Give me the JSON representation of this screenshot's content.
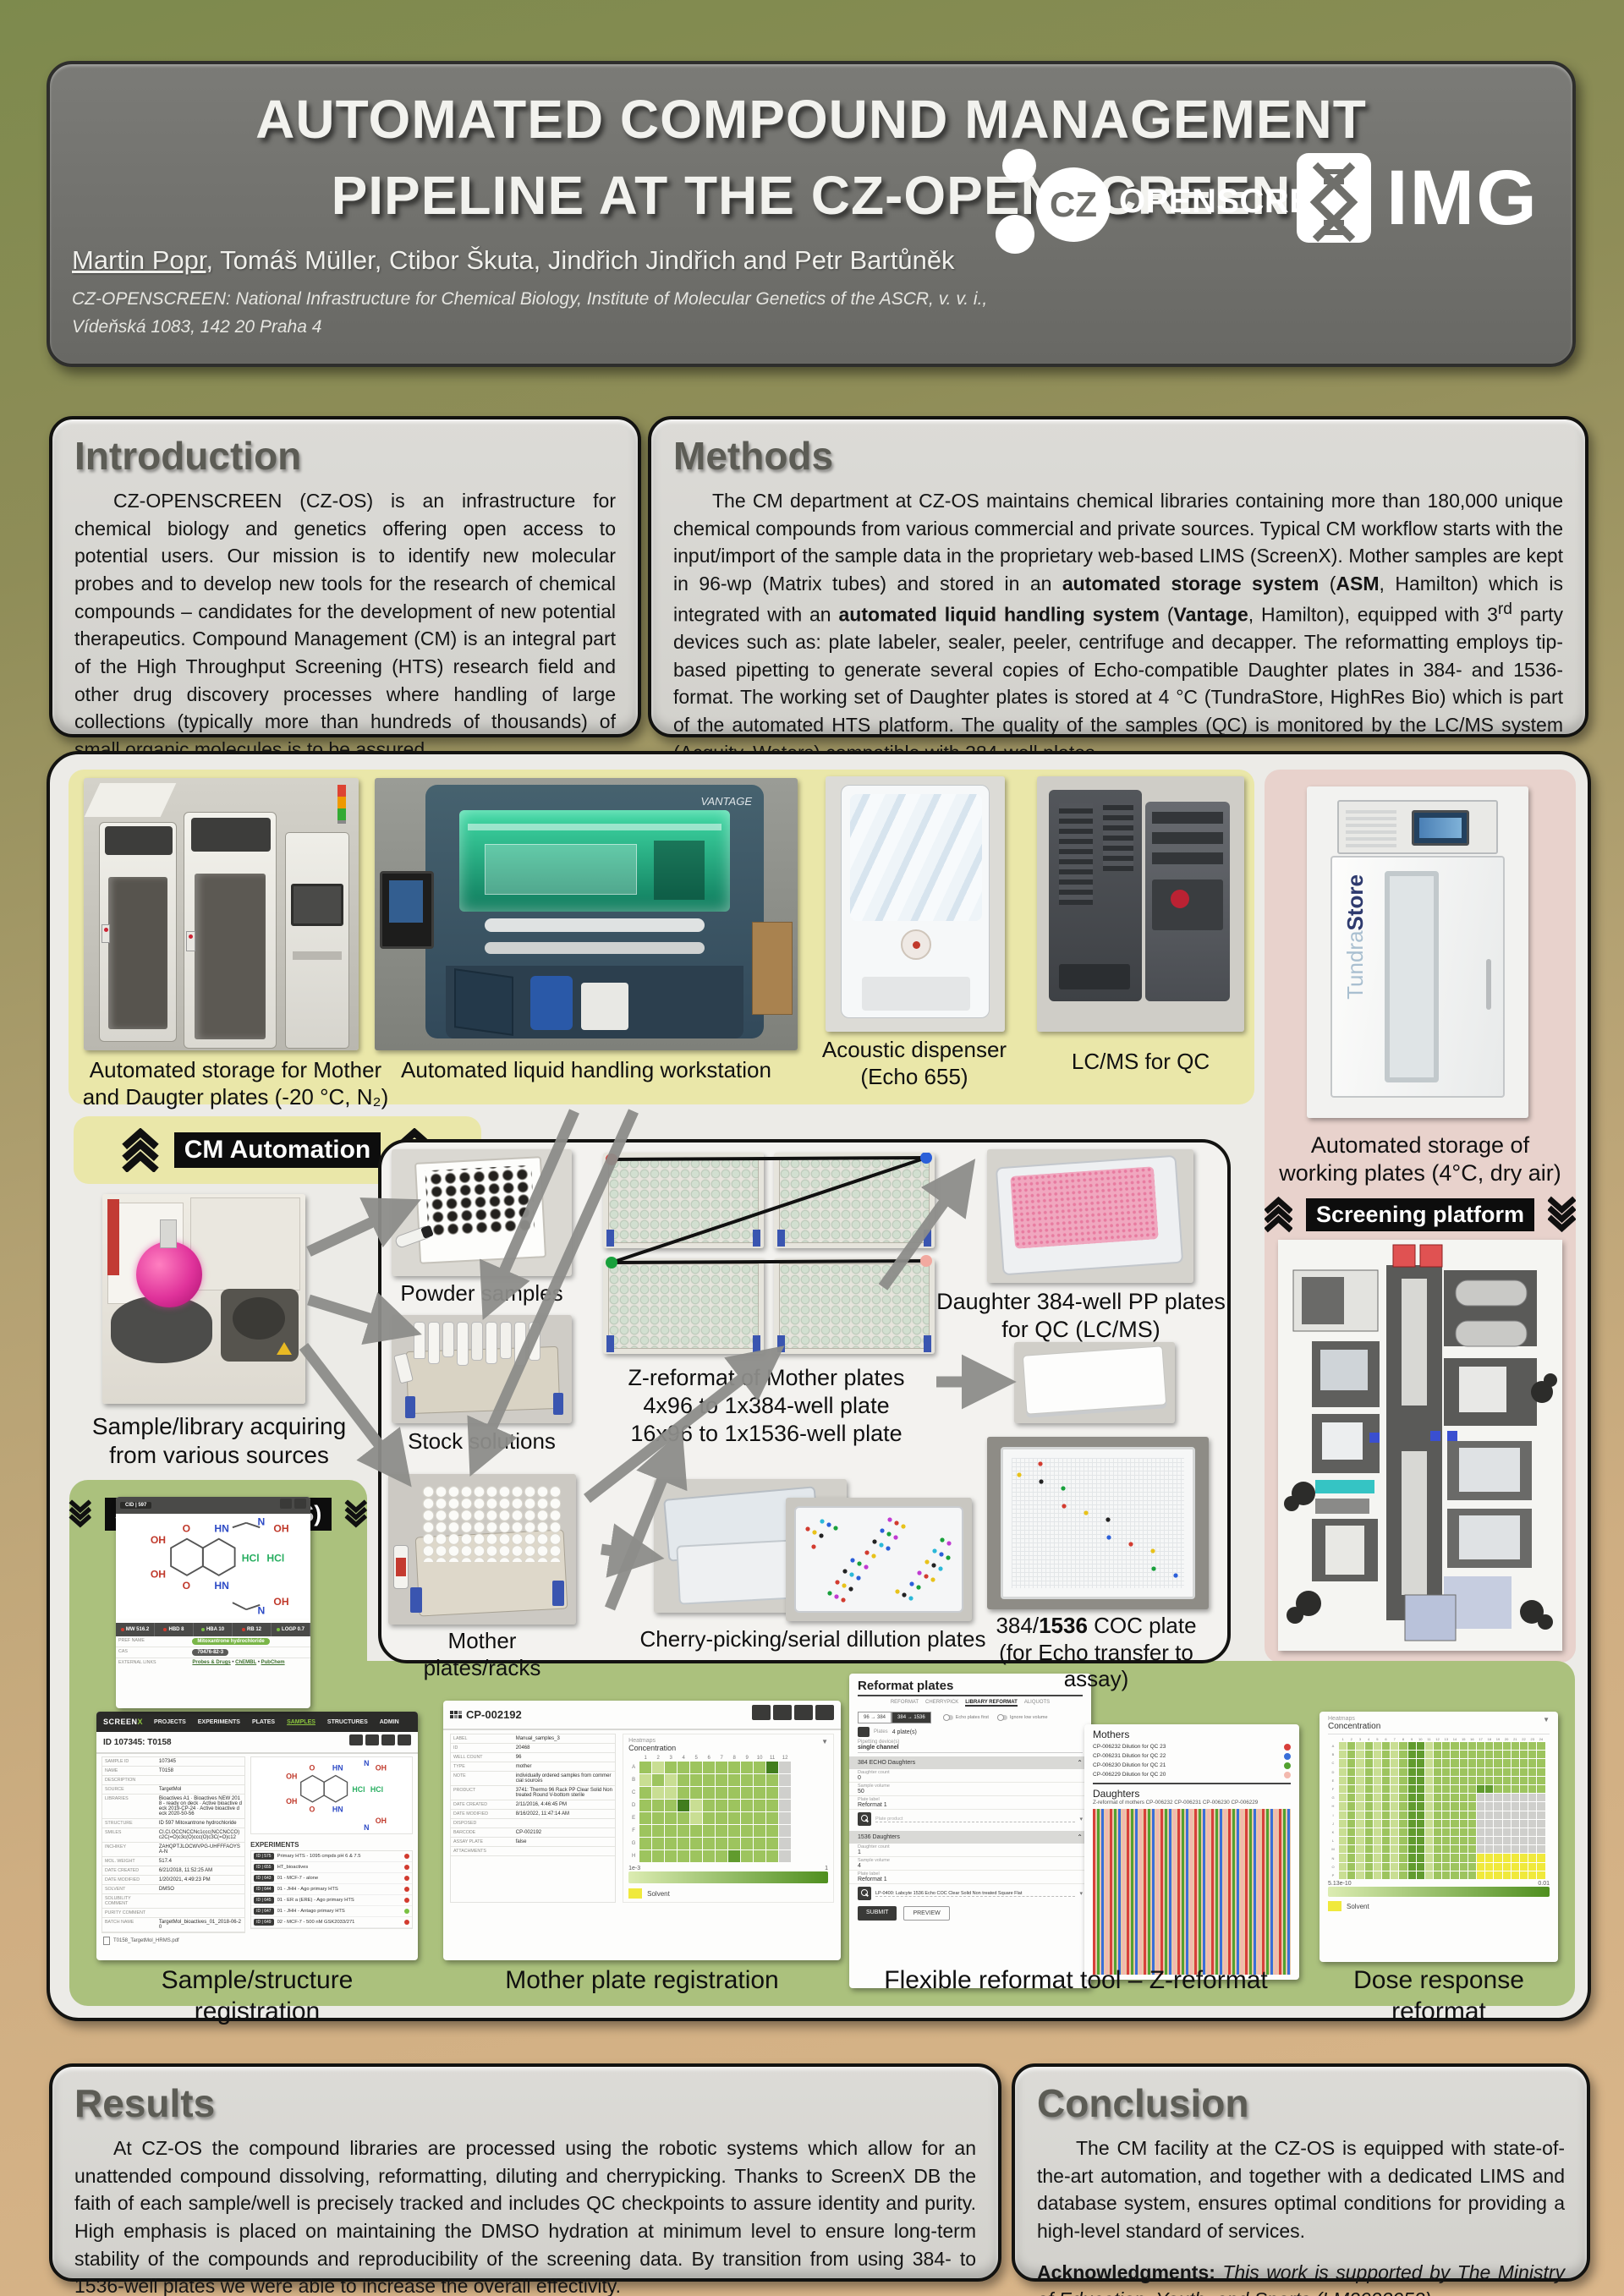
{
  "header": {
    "title_line1": "AUTOMATED COMPOUND MANAGEMENT",
    "title_line2": "PIPELINE AT THE CZ-OPENSCREEN",
    "authors_lead": "Martin Popr",
    "authors_rest": ", Tomáš Müller, Ctibor Škuta, Jindřich Jindřich and Petr Bartůněk",
    "affiliation_line1": "CZ-OPENSCREEN: National Infrastructure for Chemical Biology, Institute of Molecular Genetics of the ASCR, v. v. i.,",
    "affiliation_line2": "Vídeňská 1083, 142 20 Praha 4",
    "cz_logo_cz": "CZ",
    "cz_logo_text": "OPENSCREEN",
    "img_logo_text": "IMG"
  },
  "intro": {
    "heading": "Introduction",
    "body": "CZ-OPENSCREEN (CZ-OS) is an infrastructure for chemical biology and genetics offering open access to potential users. Our mission is to identify new molecular probes and to develop new tools for the research of chemical compounds – candidates for the development of new potential therapeutics. Compound Management (CM) is an integral part of the High Throughput Screening (HTS) research field and other drug discovery processes where handling of large collections (typically more than hundreds of thousands) of small organic molecules is to be assured."
  },
  "methods": {
    "heading": "Methods",
    "segments": [
      {
        "t": "The CM department at CZ-OS maintains chemical libraries containing more than 180,000 unique chemical compounds from various commercial and private sources. Typical CM workflow starts with the input/import of the sample data in the proprietary web-based LIMS (ScreenX). Mother samples are kept in 96-wp (Matrix tubes) and stored in an "
      },
      {
        "t": "automated storage system",
        "b": 1
      },
      {
        "t": " ("
      },
      {
        "t": "ASM",
        "b": 1
      },
      {
        "t": ", Hamilton) which is integrated with an "
      },
      {
        "t": "automated liquid handling system",
        "b": 1
      },
      {
        "t": " ("
      },
      {
        "t": "Vantage",
        "b": 1
      },
      {
        "t": ", Hamilton), equipped with 3"
      },
      {
        "t": "rd",
        "sup": 1
      },
      {
        "t": " party devices such as: plate labeler, sealer, peeler, centrifuge and decapper. The reformatting employs tip-based pipetting to generate several copies of Echo-compatible Daughter plates in 384- and 1536-format. The working set of Daughter plates is stored at 4 °C (TundraStore, HighRes Bio) which is part of the automated HTS platform. The quality of the samples (QC) is monitored by the LC/MS system (Acquity, Waters) compatible with 384-well plates."
      }
    ]
  },
  "results": {
    "heading": "Results",
    "body": "At CZ-OS the compound libraries are processed using the robotic systems which allow for an unattended compound dissolving, reformatting, diluting and cherrypicking. Thanks to ScreenX DB the faith of each sample/well is precisely tracked and includes QC checkpoints to assure identity and purity. High emphasis is placed on maintaining the DMSO hydration at minimum level to ensure long-term stability of the compounds and reproducibility of the screening data. By transition from using 384- to 1536-well plates we were able to increase the overall effectivity."
  },
  "conclusion": {
    "heading": "Conclusion",
    "body": "The CM facility at the CZ-OS is equipped with state-of-the-art automation, and together with a dedicated LIMS and database system, ensures optimal conditions for providing a high-level standard of services.",
    "ack_label": "Acknowledgments:",
    "ack_text": " This work is supported by The Ministry of Education, Youth, and Sports (LM2023052)."
  },
  "badges": {
    "cm": "CM Automation",
    "screenx": "ScreenX DB (LIMS)",
    "platform": "Screening platform"
  },
  "pipeline": {
    "cap_storage": [
      "Automated storage for Mother",
      "and Daugter plates (-20 °C, N₂)"
    ],
    "cap_liquid": "Automated liquid handling workstation",
    "cap_acoustic": [
      "Acoustic dispenser",
      "(Echo 655)"
    ],
    "cap_lcms": "LC/MS for QC",
    "cap_tundra": [
      "Automated storage of",
      "working plates (4°C, dry air)"
    ],
    "cap_sample": [
      "Sample/library acquiring",
      "from various sources"
    ],
    "cap_powder": "Powder samples",
    "cap_stock": "Stock solutions",
    "cap_mother": "Mother plates/racks",
    "zreformat": [
      "Z-reformat of Mother plates",
      "4x96 to 1x384-well plate",
      "16x96 to 1x1536-well plate"
    ],
    "cap_daughter": [
      "Daughter 384-well PP plates",
      "for QC (LC/MS)"
    ],
    "cap_cherry": "Cherry-picking/serial dillution plates",
    "cap_coc_line1": [
      {
        "t": "384/"
      },
      {
        "t": "1536",
        "b": 1
      },
      {
        "t": " COC plate"
      }
    ],
    "cap_coc_line2": "(for Echo transfer to assay)",
    "tundra_label_light": "Tundra",
    "tundra_label_bold": "Store",
    "vantage_label": "VANTAGE"
  },
  "cid_card": {
    "header": "CID | 597",
    "metrics": [
      [
        "MW",
        "516.2",
        "r"
      ],
      [
        "HBD",
        "8",
        "r"
      ],
      [
        "HBA",
        "10",
        "g"
      ],
      [
        "RB",
        "12",
        "r"
      ],
      [
        "LOGP",
        "0.7",
        "g"
      ]
    ],
    "pref_label": "PREF NAME",
    "pref_value": "Mitoxantrone hydrochloride",
    "cas_label": "CAS",
    "cas_value": "70476-82-3",
    "links_label": "EXTERNAL LINKS",
    "links": [
      "Probes & Drugs",
      "ChEMBL",
      "PubChem"
    ]
  },
  "shots": {
    "screenx": {
      "brand": "SCREENX",
      "nav": [
        "PROJECTS",
        "EXPERIMENTS",
        "PLATES",
        "SAMPLES",
        "STRUCTURES",
        "ADMIN"
      ],
      "record": "ID 107345: T0158",
      "fields": [
        [
          "SAMPLE ID",
          "107345"
        ],
        [
          "NAME",
          "T0158"
        ],
        [
          "DESCRIPTION",
          ""
        ],
        [
          "SOURCE",
          "TargetMol"
        ],
        [
          "LIBRARIES",
          "Bioactives A1 · Bioactives NEW 2018 - ready on deck · Active bioactive deck 2019-CP-24 · Active bioactive deck 2020-50-56"
        ],
        [
          "STRUCTURE",
          "ID 597 Mitoxantrone hydrochloride"
        ],
        [
          "SMILES",
          "Cl.Cl.OCCNCCNc1ccc(NCCNCCO)c2C(=O)c3c(O)ccc(O)c3C(=O)c12"
        ],
        [
          "INCHIKEY",
          "ZAHQPTJLOCWVPG-UHFFFAOYSA-N"
        ],
        [
          "MOL. WEIGHT",
          "517.4"
        ],
        [
          "DATE CREATED",
          "6/21/2018, 11:52:25 AM"
        ],
        [
          "DATE MODIFIED",
          "1/20/2021, 4:49:23 PM"
        ],
        [
          "SOLVENT",
          "DMSO"
        ],
        [
          "SOLUBILITY COMMENT",
          ""
        ],
        [
          "PURITY COMMENT",
          ""
        ],
        [
          "BATCH NAME",
          "TargetMol_bioactives_01_2018-06-20"
        ]
      ],
      "attachment": "T0158_TargetMol_HRMS.pdf",
      "exp_title": "EXPERIMENTS",
      "experiments": [
        [
          "ID | 575",
          "Primary HTS - 1095 cmpds pH 6 & 7.5",
          "r"
        ],
        [
          "ID | 655",
          "HT_bioactives",
          "r"
        ],
        [
          "ID | 643",
          "01 - MCF-7 - alone",
          "r"
        ],
        [
          "ID | 644",
          "01 - JHH - Ago primary HTS",
          "r"
        ],
        [
          "ID | 645",
          "01 - ER a (ERE) - Ago primary HTS",
          "r"
        ],
        [
          "ID | 647",
          "01 - JHH - Antago primary HTS",
          "g"
        ],
        [
          "ID | 649",
          "02 - MCF-7 - 500 nM GSK2033/271",
          "r"
        ]
      ],
      "caption": "Sample/structure registration"
    },
    "plate": {
      "barcode": "CP-002192",
      "fields": [
        [
          "LABEL",
          "Manual_samples_3"
        ],
        [
          "ID",
          "20468"
        ],
        [
          "WELL COUNT",
          "96"
        ],
        [
          "TYPE",
          "mother"
        ],
        [
          "NOTE",
          "individually ordered samples from commercial sources"
        ],
        [
          "PRODUCT",
          "3741: Thermo 96 Rack PP Clear Solid Non treated Round V-bottom sterile"
        ],
        [
          "DATE CREATED",
          "2/11/2016, 4:46:45 PM"
        ],
        [
          "DATE MODIFIED",
          "8/16/2022, 11:47:14 AM"
        ],
        [
          "DISPOSED",
          ""
        ],
        [
          "BARCODE",
          "CP-002192"
        ],
        [
          "ASSAY PLATE",
          "false"
        ],
        [
          "ATTACHMENTS",
          ""
        ]
      ],
      "hm_title": "Heatmaps",
      "hm_sub": "Concentration",
      "rows": "ABCDEFGH",
      "grid": [
        "mlmmmmmmmmDx",
        "lmlmmmmmmmmx",
        "mllmmmmmmmmx",
        "mmmDlmmmmmmx",
        "mmmmlmmmmmmx",
        "mmmmmmmmmmmx",
        "mmmmmmmmmmmx",
        "mmmmmmmdmmmx"
      ],
      "scale_min": "1e-3",
      "scale_max": "1",
      "legend": "Solvent",
      "caption": "Mother plate registration"
    },
    "reformat": {
      "title": "Reformat plates",
      "tabs": [
        "REFORMAT",
        "CHERRYPICK",
        "LIBRARY REFORMAT",
        "ALIQUOTS"
      ],
      "active_tab": 2,
      "modes": [
        "96 → 384",
        "384 → 1536"
      ],
      "active_mode": 1,
      "toggles": [
        "Echo plates first",
        "Ignore low volume"
      ],
      "plates_label": "Plates",
      "plates_value": "4 plate(s)",
      "device_label": "Pipetting device(s)",
      "device_value": "single channel",
      "product_label": "Plate product",
      "sections": [
        {
          "title": "384 ECHO Daughters",
          "fields": [
            [
              "Daughter count",
              "0"
            ],
            [
              "Sample volume",
              "50"
            ],
            [
              "Plate label",
              "Reformat 1"
            ]
          ],
          "product": ""
        },
        {
          "title": "1536 Daughters",
          "fields": [
            [
              "Daughter count",
              "1"
            ],
            [
              "Sample volume",
              "4"
            ],
            [
              "Plate label",
              "Reformat 1"
            ]
          ],
          "product": "LP-0400: Labcyte 1536 Echo COC Clear Solid Non treated Square Flat"
        }
      ],
      "submit": "SUBMIT",
      "preview": "PREVIEW",
      "mothers_title": "Mothers",
      "mothers": [
        [
          "CP-006232 Dilution for QC 23",
          "#d8403b"
        ],
        [
          "CP-006231 Dilution for QC 22",
          "#3a6fd8"
        ],
        [
          "CP-006230 Dilution for QC 21",
          "#53a12f"
        ],
        [
          "CP-006229 Dilution for QC 20",
          "#f3b9ae"
        ]
      ],
      "daughters_title": "Daughters",
      "daughters_sub": "Z-reformat of mothers CP-006232 CP-006231 CP-006230 CP-006229",
      "caption": "Flexible reformat tool – Z-reformat"
    },
    "dose": {
      "hm_title": "Heatmaps",
      "hm_sub": "Concentration",
      "rows": "ABCDEFGHIJKLMNOP",
      "grid": [
        "lmlmlmlmddlmmmmmmmmmmmmm",
        "lmlmlmlmddlmmmmmmmmmmmmm",
        "lmlmlmlmddlmmmmmmmmmmmmm",
        "lmlmlmlmddlmmmmmmmmmmmmm",
        "lmlmlmlmddlmmmmmmmmmmmmm",
        "lmlmlmlmddlmmmmmddmmmmmm",
        "lmlmlmlmddlmmmmmxxxxxxxx",
        "lmlmlmlmddlmmmmmxxxxxxxx",
        "lmlmlmlmddlmmmmmxxxxxxxx",
        "lmlmlmlmddlmmmmmxxxxxxxx",
        "lmlmlmlmddlmmmmmxxxxxxxx",
        "lmlmlmlmddlmmmmmxxxxxxxx",
        "lmlmlmlmddlmmmmmxxxxxxxx",
        "lmlmlmlmddlmmmmmyyyyyyyy",
        "lmlmlmlmddlmmmmmyyyyyyyy",
        "lmlmlmlmddlmmmmmyyyyyyyy"
      ],
      "scale_min": "5.13e-10",
      "scale_max": "0.01",
      "legend": "Solvent",
      "caption": "Dose response reformat"
    }
  },
  "palette": {
    "l": "#c9de93",
    "m": "#9dc45e",
    "d": "#619b2e",
    "D": "#417d1d",
    "x": "#cfcfcc",
    "y": "#f0e93c"
  }
}
